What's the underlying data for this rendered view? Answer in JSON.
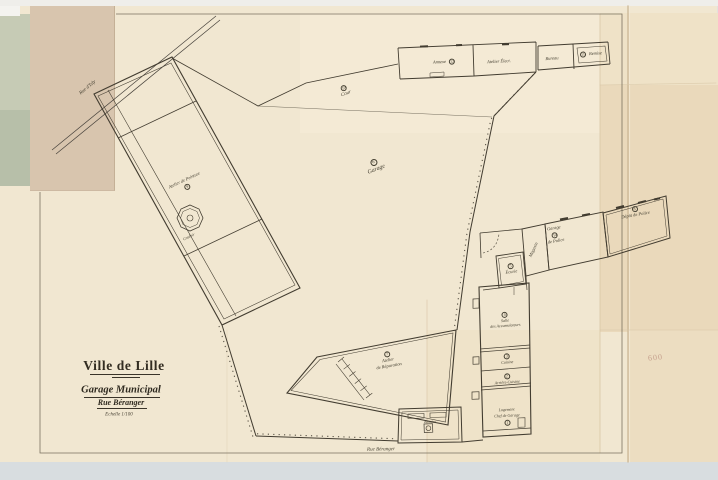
{
  "title_block": {
    "city": "Ville de Lille",
    "project": "Garage Municipal",
    "street": "Rue Béranger",
    "scale": "Echelle 1/100"
  },
  "streets": {
    "top_left": "Rue d'Isly",
    "bottom": "Rue Béranger"
  },
  "rooms": {
    "atelier_peinture": {
      "label": "Atelier de Peinture",
      "number": "9"
    },
    "couloir": {
      "label": "Couloir"
    },
    "cour": {
      "label": "Cour",
      "number": "10"
    },
    "garage_central": {
      "label": "Garage",
      "number": "6"
    },
    "annexe": {
      "label": "Annexe",
      "number": "12"
    },
    "atelier_electricite": {
      "label": "Atelier Élect."
    },
    "bureau": {
      "label": "Bureau"
    },
    "remise_haut": {
      "label": "Remise",
      "number": "11"
    },
    "magasin": {
      "label": "Magasin"
    },
    "garage_police": {
      "label_line1": "Garage",
      "label_line2": "de Police",
      "number": "14"
    },
    "depot_police": {
      "label": "Dépôt de Police",
      "number": "8"
    },
    "ecurie": {
      "label": "Écurie",
      "number": "5"
    },
    "salle_accumulateurs": {
      "label_line1": "Salle",
      "label_line2": "des Accumulateurs",
      "number": "4"
    },
    "cuisine": {
      "label": "Cuisine",
      "number": "3"
    },
    "arriere_cuisine": {
      "label": "Arrière-Cuisine",
      "number": "2"
    },
    "logement": {
      "label_line1": "Logement",
      "label_line2": "Chef de Garage",
      "number": "1"
    },
    "atelier_reparation": {
      "label_line1": "Atelier",
      "label_line2": "de Réparation",
      "number": "7"
    },
    "remise_bas": {
      "label": "Remise"
    }
  },
  "annotations": {
    "stamp": "600"
  },
  "colors": {
    "paper": "#f1e7d1",
    "paper_fold": "#ead9bb",
    "ink": "#423c30",
    "backing_green": "#b7bfa9",
    "band_tan": "#d8c5ae",
    "tray_gray": "#d8dde0",
    "stamp_red": "#b07a6e"
  }
}
